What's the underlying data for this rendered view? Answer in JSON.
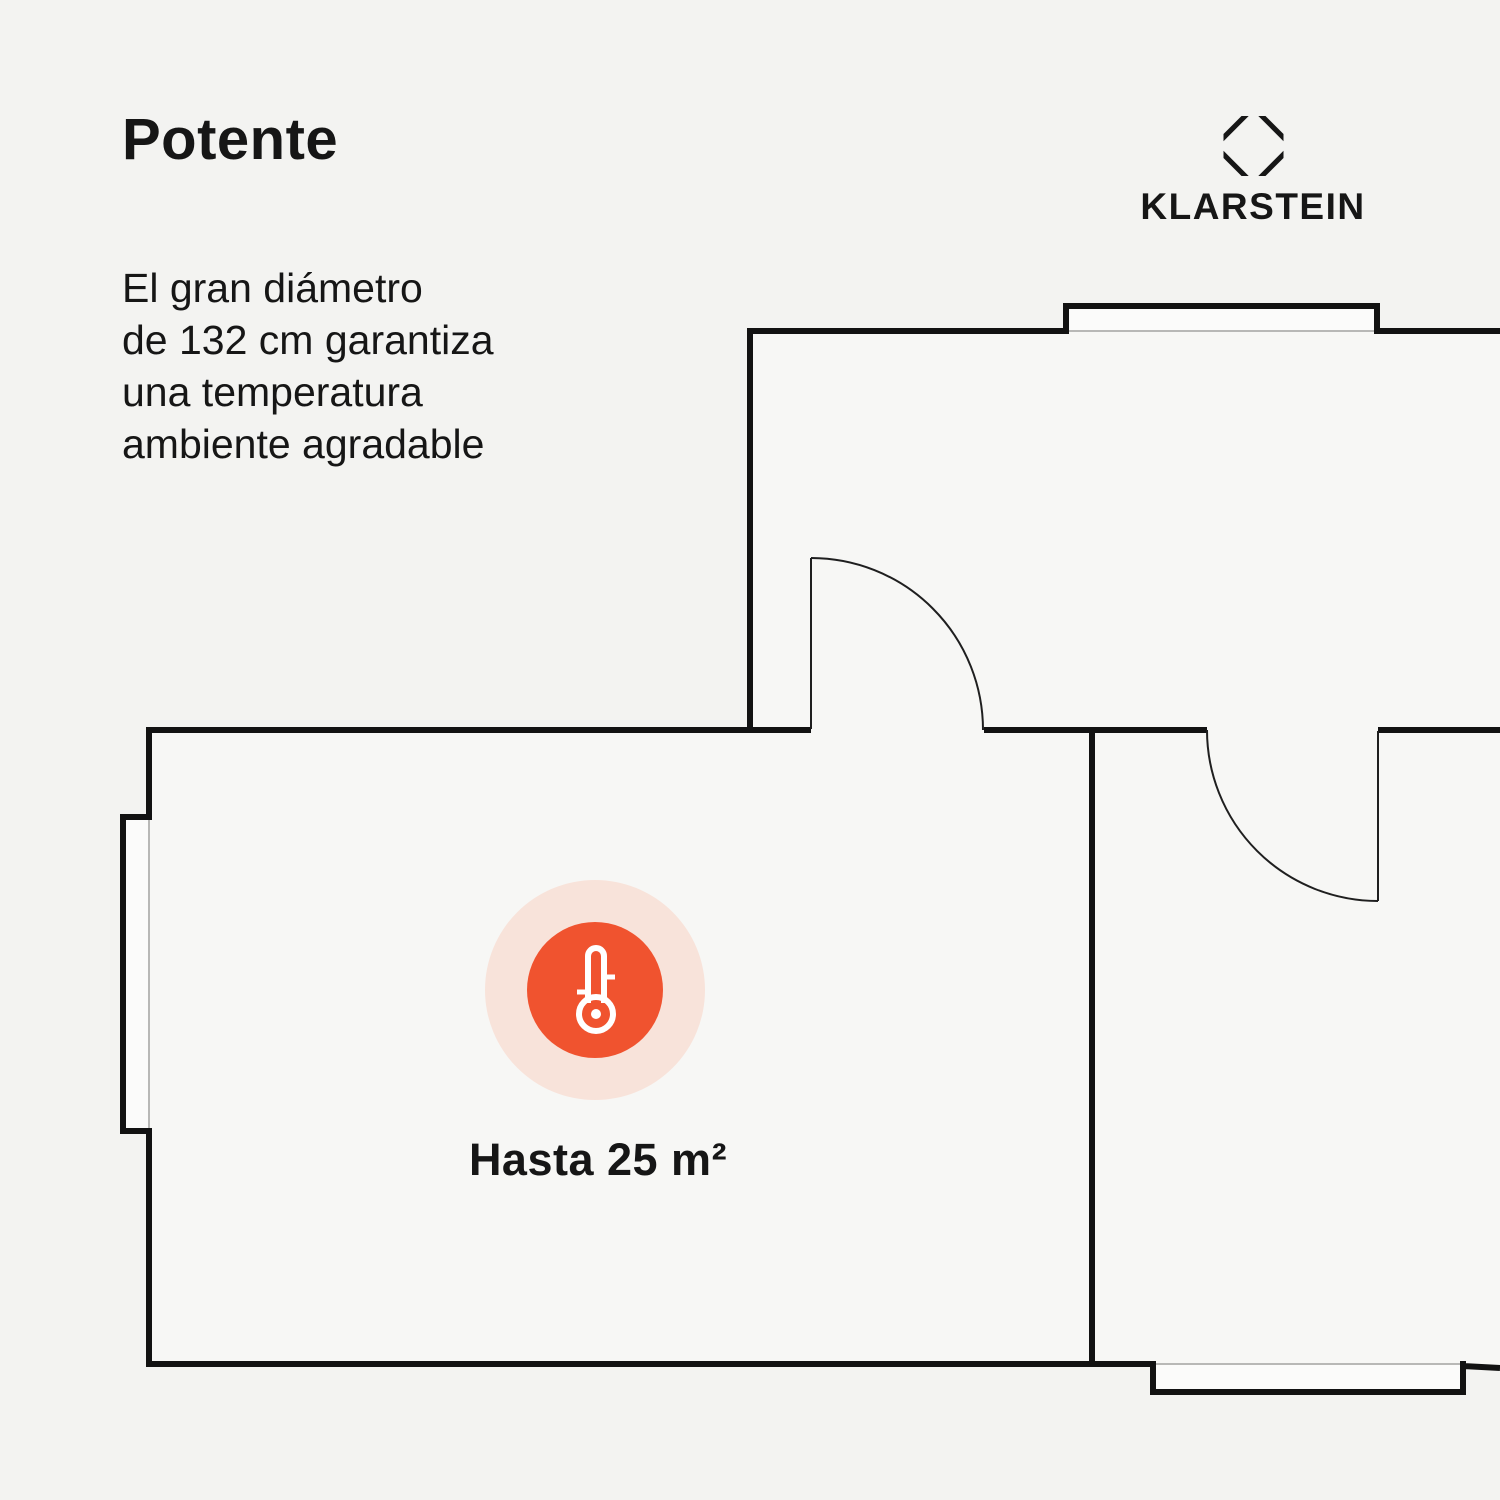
{
  "page": {
    "title": "Potente",
    "description_lines": [
      "El gran diámetro",
      "de 132 cm garantiza",
      "una temperatura",
      "ambiente agradable"
    ]
  },
  "brand": {
    "name": "KLARSTEIN",
    "logo_icon": "klarstein-octagon-logo-icon"
  },
  "floorplan": {
    "area_label": "Hasta 25 m²",
    "indicator_icon": "thermometer-icon"
  },
  "colors": {
    "bg": "#f3f3f1",
    "room_fill": "#f7f7f5",
    "bay_fill": "#fbfbfa",
    "wall": "#121212",
    "thin_line": "#b8b8b6",
    "door_line": "#1f1f1f",
    "text": "#161616",
    "accent_orange": "#f0532f",
    "accent_halo": "#f8e3da",
    "icon_white": "#ffffff"
  }
}
